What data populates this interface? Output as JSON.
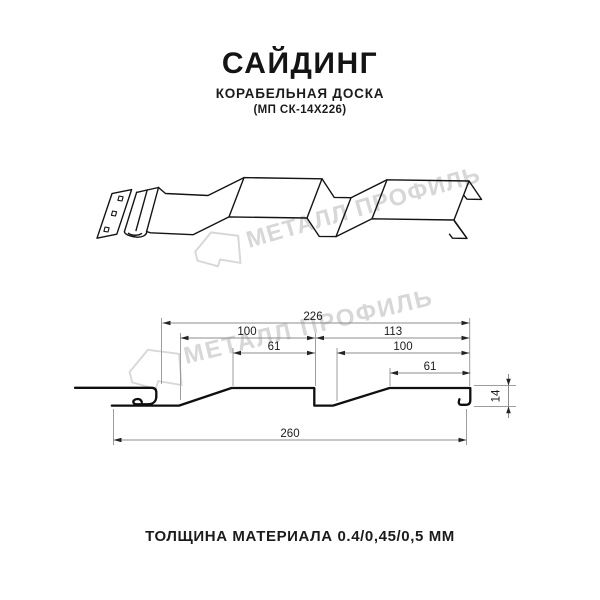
{
  "header": {
    "title": "САЙДИНГ",
    "subtitle": "КОРАБЕЛЬНАЯ ДОСКА",
    "model_code": "(МП СК-14Х226)"
  },
  "footer": {
    "text": "ТОЛЩИНА МАТЕРИАЛА 0.4/0,45/0,5 ММ"
  },
  "watermark": {
    "text": "МЕТАЛЛ ПРОФИЛЬ",
    "logo": "metal-profile-pentagon-logo",
    "color": "#d7d7d7"
  },
  "drawing": {
    "type": "technical-profile-section",
    "dims": {
      "overall_top": "226",
      "upper_left": "100",
      "upper_right": "113",
      "inner_left": "61",
      "inner_right": "100",
      "small_right": "61",
      "bottom": "260",
      "height": "14"
    }
  },
  "colors": {
    "line": "#141414",
    "profile": "#0f0f0f",
    "dim_line": "#8c8c8c",
    "arrow": "#242424",
    "watermark": "#d7d7d7"
  }
}
